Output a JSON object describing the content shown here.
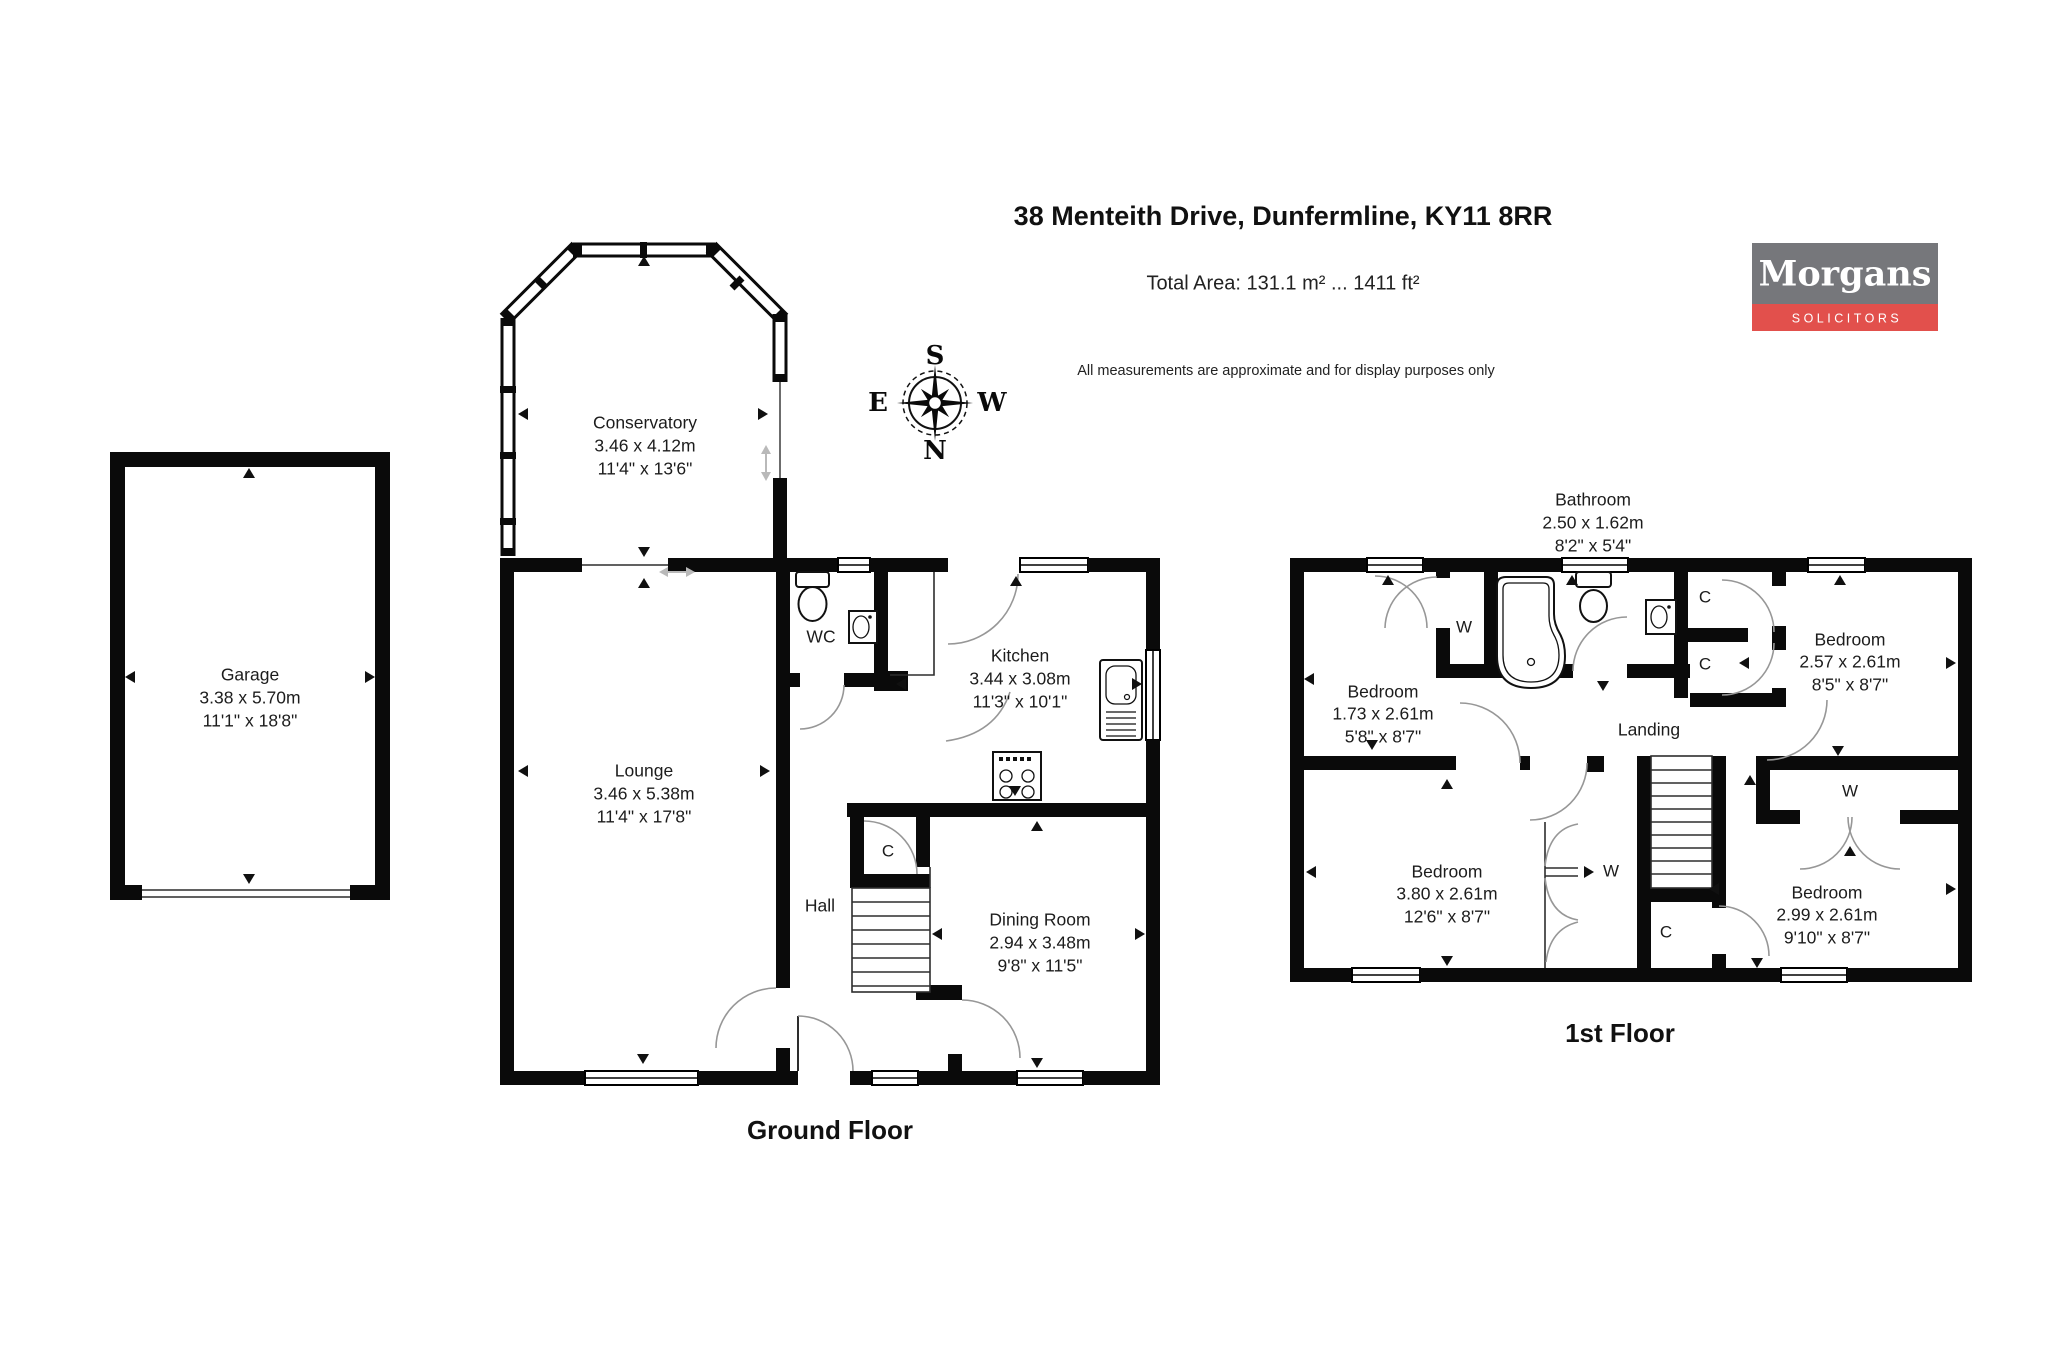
{
  "header": {
    "title": "38 Menteith Drive, Dunfermline, KY11 8RR",
    "total_area": "Total Area: 131.1 m² ... 1411 ft²",
    "disclaimer": "All measurements are approximate and for display purposes only"
  },
  "logo": {
    "name": "Morgans",
    "tagline": "SOLICITORS",
    "colors": {
      "gray": "#76777B",
      "red": "#E2504C"
    }
  },
  "compass": {
    "top": "S",
    "bottom": "N",
    "left": "E",
    "right": "W"
  },
  "ground_floor": {
    "label": "Ground Floor",
    "rooms": {
      "garage": {
        "name": "Garage",
        "metric": "3.38 x 5.70m",
        "imperial": "11'1\" x 18'8\""
      },
      "conservatory": {
        "name": "Conservatory",
        "metric": "3.46 x 4.12m",
        "imperial": "11'4\" x 13'6\""
      },
      "lounge": {
        "name": "Lounge",
        "metric": "3.46 x 5.38m",
        "imperial": "11'4\" x 17'8\""
      },
      "wc": {
        "name": "WC"
      },
      "kitchen": {
        "name": "Kitchen",
        "metric": "3.44 x 3.08m",
        "imperial": "11'3\" x 10'1\""
      },
      "hall": {
        "name": "Hall"
      },
      "dining_room": {
        "name": "Dining Room",
        "metric": "2.94 x 3.48m",
        "imperial": "9'8\" x 11'5\""
      }
    },
    "markers": {
      "cupboard": "C"
    }
  },
  "first_floor": {
    "label": "1st Floor",
    "rooms": {
      "bathroom": {
        "name": "Bathroom",
        "metric": "2.50 x 1.62m",
        "imperial": "8'2\" x 5'4\""
      },
      "bedroom_1": {
        "name": "Bedroom",
        "metric": "1.73 x 2.61m",
        "imperial": "5'8\" x 8'7\""
      },
      "bedroom_2": {
        "name": "Bedroom",
        "metric": "2.57 x 2.61m",
        "imperial": "8'5\" x 8'7\""
      },
      "bedroom_3": {
        "name": "Bedroom",
        "metric": "3.80 x 2.61m",
        "imperial": "12'6\" x 8'7\""
      },
      "bedroom_4": {
        "name": "Bedroom",
        "metric": "2.99 x 2.61m",
        "imperial": "9'10\" x 8'7\""
      },
      "landing": {
        "name": "Landing"
      }
    },
    "markers": {
      "wardrobe": "W",
      "cupboard": "C"
    }
  }
}
